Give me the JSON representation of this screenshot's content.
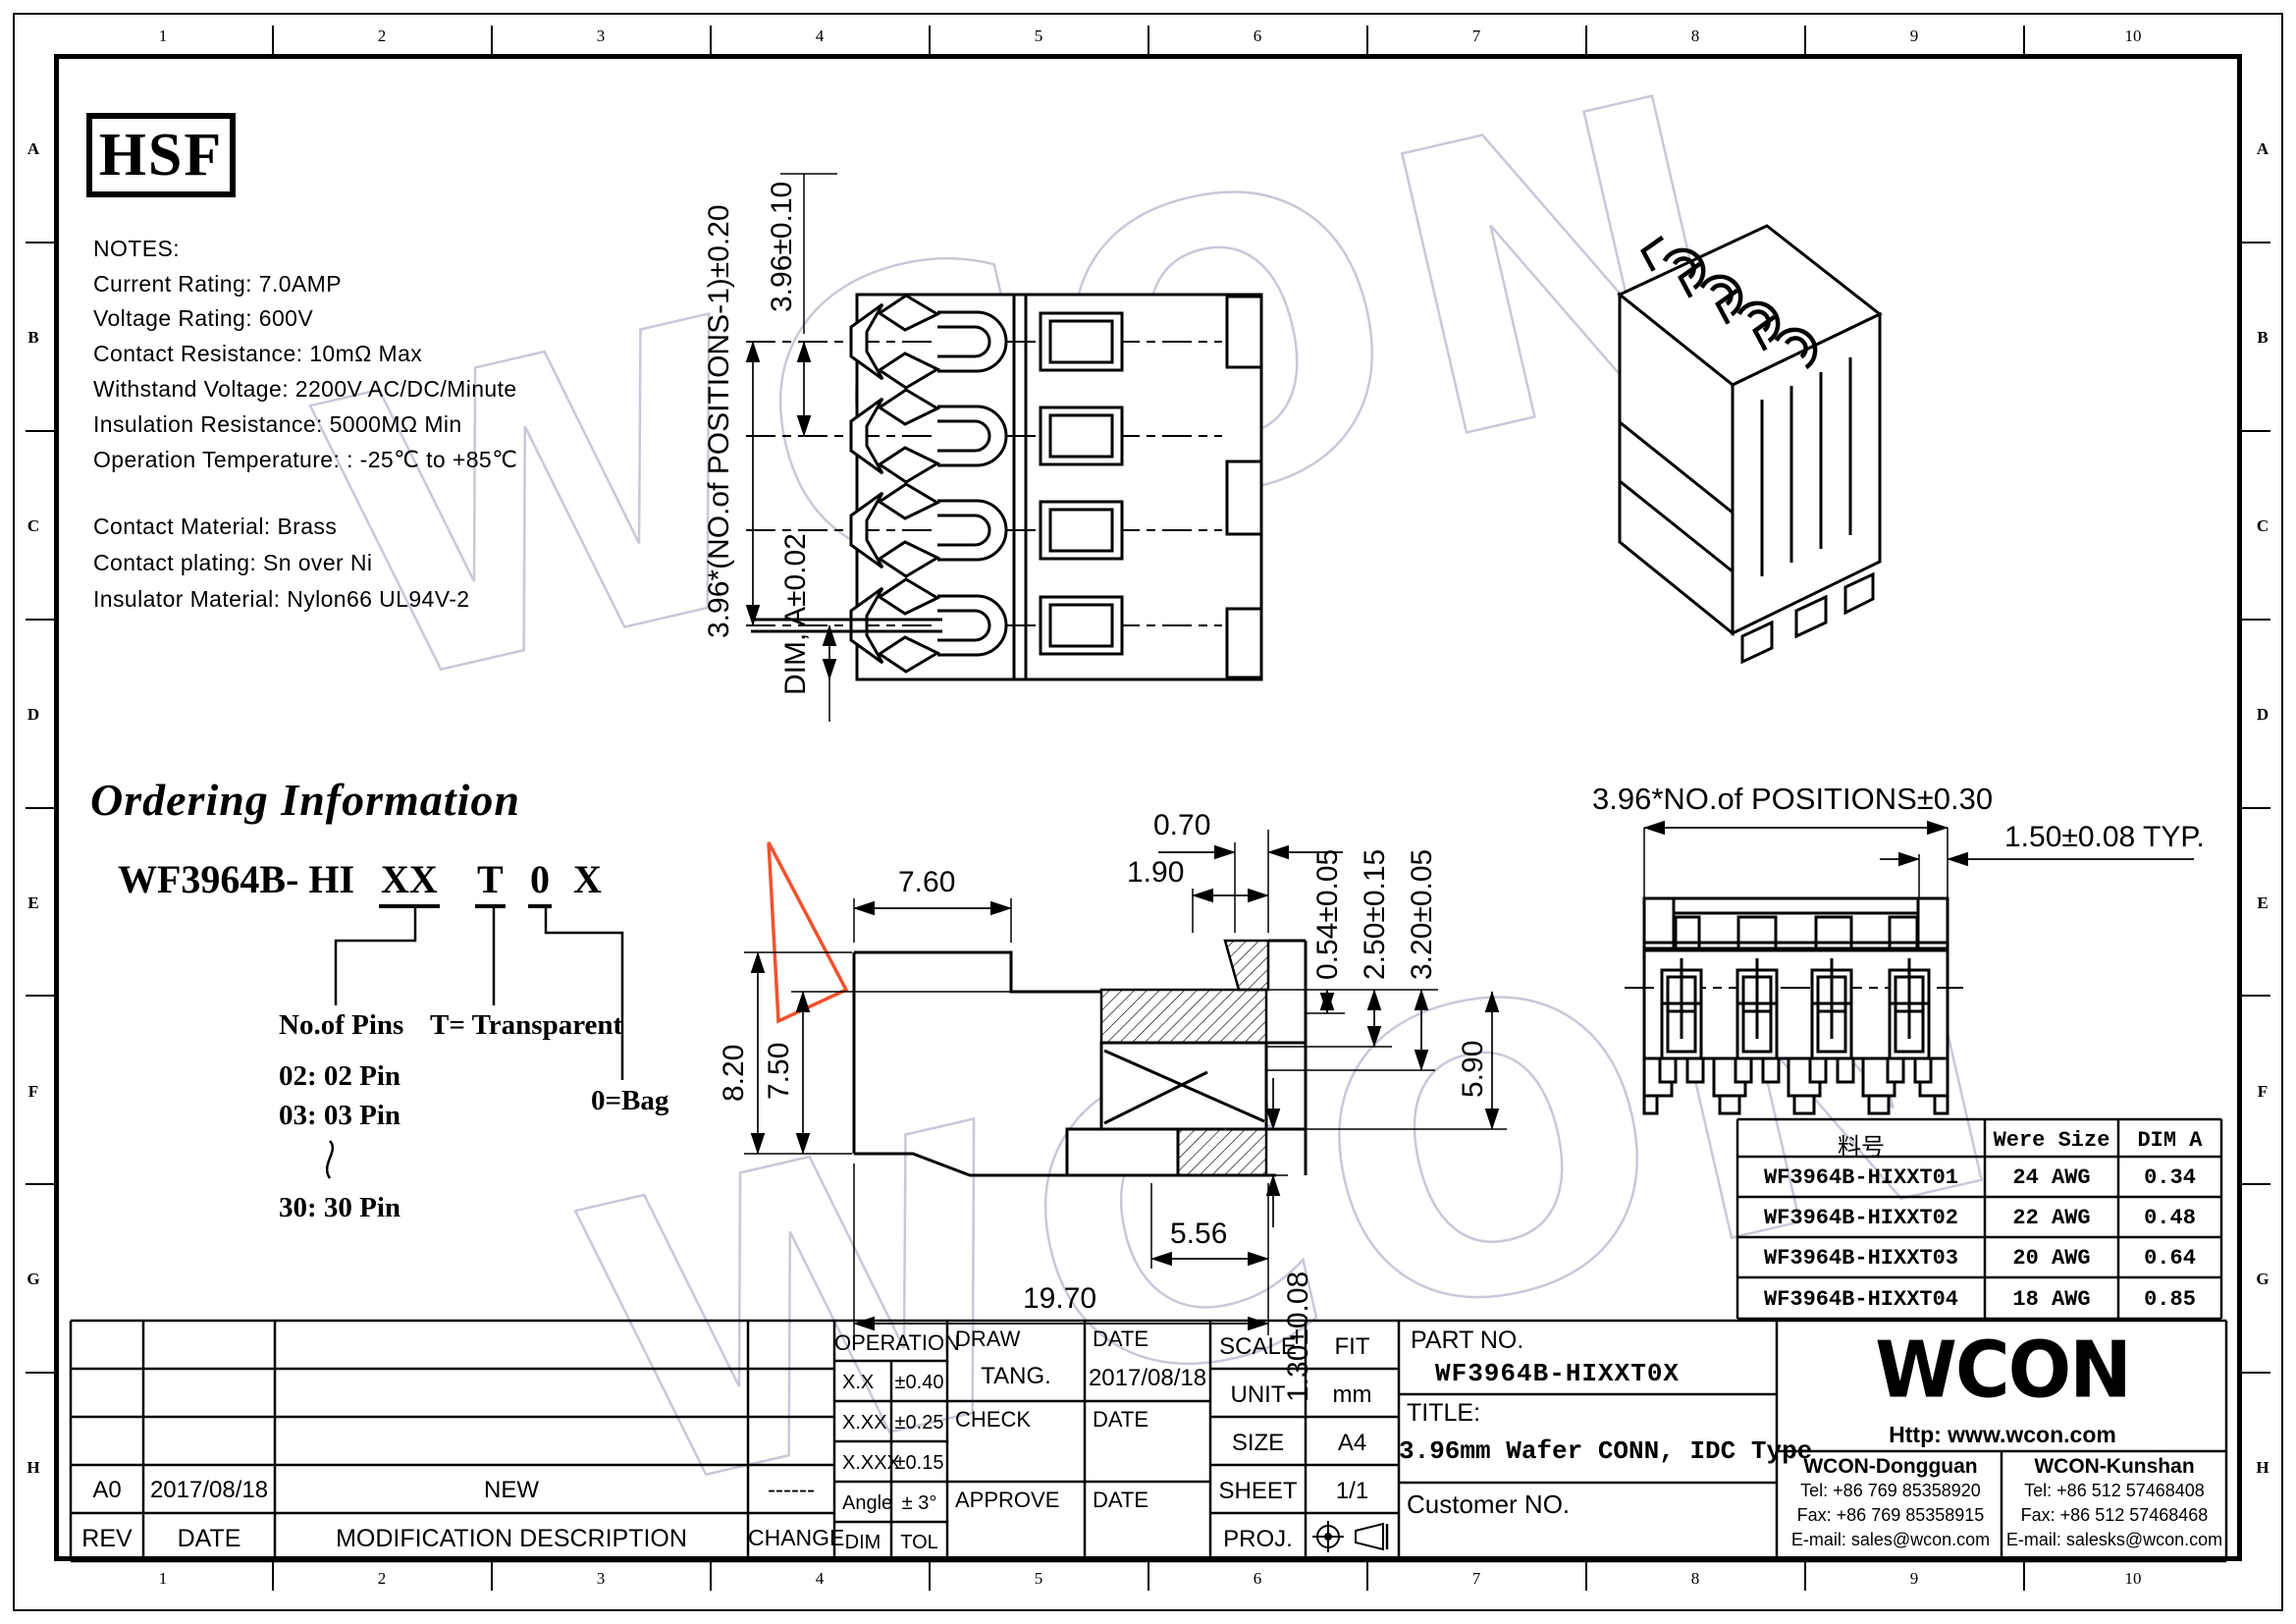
{
  "frame": {
    "columns": [
      "1",
      "2",
      "3",
      "4",
      "5",
      "6",
      "7",
      "8",
      "9",
      "10"
    ],
    "rows": [
      "A",
      "B",
      "C",
      "D",
      "E",
      "F",
      "G",
      "H"
    ]
  },
  "logo_text": "HSF",
  "notes": {
    "title": "NOTES:",
    "lines": [
      "Current Rating: 7.0AMP",
      "Voltage Rating: 600V",
      "Contact Resistance: 10mΩ Max",
      "Withstand Voltage: 2200V AC/DC/Minute",
      "Insulation Resistance: 5000MΩ Min",
      "Operation Temperature: : -25℃ to +85℃"
    ]
  },
  "materials": {
    "lines": [
      "Contact Material: Brass",
      "Contact plating: Sn over Ni",
      "Insulator Material: Nylon66 UL94V-2"
    ]
  },
  "ordering": {
    "heading": "Ordering Information",
    "part_base": "WF3964B- HI",
    "code_pins": "XX",
    "code_color": "T",
    "code_pack": "0",
    "code_x": "X",
    "label_pins": "No.of Pins",
    "label_color": "T= Transparent",
    "label_pack": "0=Bag",
    "pin_02": "02: 02 Pin",
    "pin_03": "03: 03 Pin",
    "pin_30": "30: 30 Pin"
  },
  "views": {
    "top": {
      "dim_overall": "3.96*(NO.of POSITIONS-1)±0.20",
      "dim_pitch": "3.96±0.10",
      "dim_a": "DIM, A±0.02"
    },
    "side": {
      "dim_w1": "7.60",
      "dim_w2": "0.70",
      "dim_w3": "1.90",
      "dim_r1": "0.54±0.05",
      "dim_r2": "2.50±0.15",
      "dim_r3": "3.20±0.05",
      "dim_h1": "8.20",
      "dim_h2": "7.50",
      "dim_h3": "5.90",
      "dim_b1": "5.56",
      "dim_b2": "19.70",
      "dim_b3": "1.30±0.08"
    },
    "front": {
      "dim_overall": "3.96*NO.of  POSITIONS±0.30",
      "dim_typ": "1.50±0.08 TYP."
    }
  },
  "parts_table": {
    "headers": [
      "料号",
      "Were Size",
      "DIM A"
    ],
    "rows": [
      [
        "WF3964B-HIXXT01",
        "24 AWG",
        "0.34"
      ],
      [
        "WF3964B-HIXXT02",
        "22 AWG",
        "0.48"
      ],
      [
        "WF3964B-HIXXT03",
        "20 AWG",
        "0.64"
      ],
      [
        "WF3964B-HIXXT04",
        "18 AWG",
        "0.85"
      ]
    ]
  },
  "revision": {
    "row": {
      "rev": "A0",
      "date": "2017/08/18",
      "desc": "NEW",
      "change": "------"
    },
    "headers": {
      "rev": "REV",
      "date": "DATE",
      "desc": "MODIFICATION  DESCRIPTION",
      "change": "CHANGE"
    }
  },
  "tolerance": {
    "header": "OPERATION",
    "rows": [
      [
        "X.X",
        "±0.40"
      ],
      [
        "X.XX",
        "±0.25"
      ],
      [
        "X.XXX",
        "±0.15"
      ],
      [
        "Angle",
        "± 3°"
      ],
      [
        "DIM",
        "TOL"
      ]
    ]
  },
  "signoff": {
    "draw": "DRAW",
    "draw_name": "TANG.",
    "date": "DATE",
    "draw_date": "2017/08/18",
    "check": "CHECK",
    "approve": "APPROVE"
  },
  "info": {
    "scale_label": "SCALE",
    "scale": "FIT",
    "unit_label": "UNIT",
    "unit": "mm",
    "size_label": "SIZE",
    "size": "A4",
    "sheet_label": "SHEET",
    "sheet": "1/1",
    "proj_label": "PROJ."
  },
  "part_info": {
    "part_no_label": "PART NO.",
    "part_no": "WF3964B-HIXXT0X",
    "title_label": "TITLE:",
    "title": "3.96mm Wafer CONN, IDC Type",
    "customer_label": "Customer NO."
  },
  "company": {
    "logo": "WCON",
    "url": "Http: www.wcon.com",
    "dongguan": {
      "name": "WCON-Dongguan",
      "tel": "Tel: +86 769 85358920",
      "fax": "Fax: +86 769 85358915",
      "email": "E-mail: sales@wcon.com"
    },
    "kunshan": {
      "name": "WCON-Kunshan",
      "tel": "Tel: +86 512 57468408",
      "fax": "Fax: +86 512 57468468",
      "email": "E-mail: salesks@wcon.com"
    }
  },
  "watermark": "WCON",
  "colors": {
    "line": "#000000",
    "watermark": "#c8c8d9",
    "highlight": "#f4512c",
    "background": "#ffffff"
  }
}
